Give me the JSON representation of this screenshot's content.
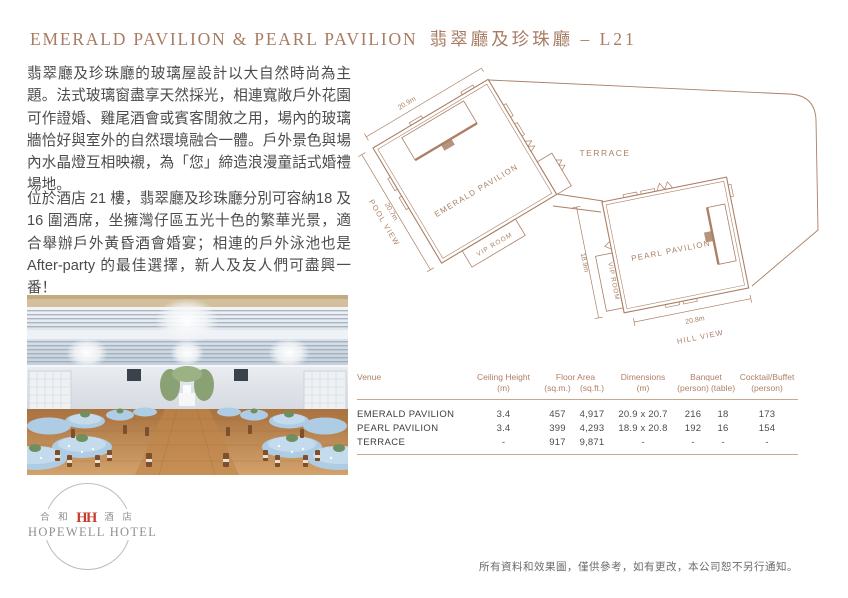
{
  "page": {
    "title_en": "EMERALD PAVILION & PEARL PAVILION",
    "title_zh": "翡翠廳及珍珠廳 – L21",
    "paragraph1": "翡翠廳及珍珠廳的玻璃屋設計以大自然時尚為主題。法式玻璃窗盡享天然採光，相連寬敞戶外花園可作證婚、雞尾酒會或賓客閒敘之用，場內的玻璃牆恰好與室外的自然環境融合一體。戶外景色與場內水晶燈互相映襯，為「您」締造浪漫童話式婚禮場地。",
    "paragraph2": "位於酒店 21 樓，翡翠廳及珍珠廳分別可容納18 及 16 圍酒席，坐擁灣仔區五光十色的繁華光景，適合舉辦戶外黃昏酒會婚宴；相連的戶外泳池也是 After-party 的最佳選擇，新人及友人們可盡興一番！",
    "disclaimer": "所有資料和效果圖，僅供參考，如有更改，本公司恕不另行通知。"
  },
  "floorplan": {
    "terrace_label": "TERRACE",
    "emerald": {
      "name": "EMERALD PAVILION",
      "dim_top": "20.9m",
      "dim_side": "20.7m",
      "view": "POOL VIEW",
      "vip": "VIP ROOM"
    },
    "pearl": {
      "name": "PEARL PAVILION",
      "dim_side": "18.9m",
      "dim_bottom": "20.8m",
      "view": "HILL VIEW",
      "vip": "VIP ROOM"
    }
  },
  "spec_table": {
    "col_venue": "Venue",
    "col_ceiling": "Ceiling Height",
    "col_ceiling_unit": "(m)",
    "col_floor": "Floor Area",
    "col_floor_unit_sqm": "(sq.m.)",
    "col_floor_unit_sqft": "(sq.ft.)",
    "col_dims": "Dimensions",
    "col_dims_unit": "(m)",
    "col_banquet": "Banquet",
    "col_banquet_unit_person": "(person)",
    "col_banquet_unit_table": "(table)",
    "col_cocktail": "Cocktail/Buffet",
    "col_cocktail_unit": "(person)",
    "rows": [
      {
        "venue": "EMERALD PAVILION",
        "ceiling": "3.4",
        "sqm": "457",
        "sqft": "4,917",
        "dims": "20.9 x 20.7",
        "banquet_person": "216",
        "banquet_table": "18",
        "cocktail": "173"
      },
      {
        "venue": "PEARL PAVILION",
        "ceiling": "3.4",
        "sqm": "399",
        "sqft": "4,293",
        "dims": "18.9 x 20.8",
        "banquet_person": "192",
        "banquet_table": "16",
        "cocktail": "154"
      },
      {
        "venue": "TERRACE",
        "ceiling": "-",
        "sqm": "917",
        "sqft": "9,871",
        "dims": "-",
        "banquet_person": "-",
        "banquet_table": "-",
        "cocktail": "-"
      }
    ]
  },
  "logo": {
    "zh_prefix": "合 和",
    "monogram": "HH",
    "zh_suffix": "酒 店",
    "hotel_name": "HOPEWELL HOTEL"
  },
  "colors": {
    "accent": "#a87c64",
    "plan_line": "#ab8066",
    "table_rule": "#c9a88f",
    "body_text": "#4b4b4b",
    "logo_red": "#c93b2a",
    "logo_gray": "#8f8f8f"
  }
}
